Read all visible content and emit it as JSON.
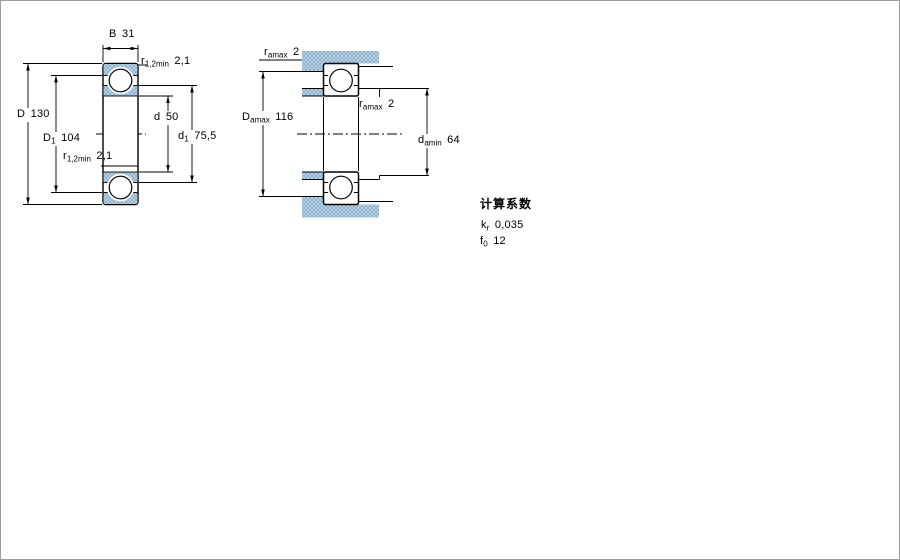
{
  "figures": {
    "left": {
      "name": "bearing cross-section",
      "dims": {
        "B": {
          "sym": "B",
          "value": "31"
        },
        "r_top": {
          "sym": "r",
          "sub": "1,2min",
          "value": "2,1"
        },
        "D": {
          "sym": "D",
          "value": "130"
        },
        "D1": {
          "sym": "D",
          "sub": "1",
          "value": "104"
        },
        "r_mid": {
          "sym": "r",
          "sub": "1,2min",
          "value": "2,1"
        },
        "d": {
          "sym": "d",
          "value": "50"
        },
        "d1": {
          "sym": "d",
          "sub": "1",
          "value": "75,5"
        }
      }
    },
    "right": {
      "name": "abutment and fillet dimensions",
      "dims": {
        "ra_top": {
          "sym": "r",
          "sub": "amax",
          "value": "2"
        },
        "Damax": {
          "sym": "D",
          "sub": "amax",
          "value": "116"
        },
        "ra_mid": {
          "sym": "r",
          "sub": "amax",
          "value": "2"
        },
        "damin": {
          "sym": "d",
          "sub": "amin",
          "value": "64"
        }
      }
    }
  },
  "calculation_factors": {
    "heading": "计算系数",
    "rows": [
      {
        "sym": "k",
        "sub": "r",
        "value": "0,035"
      },
      {
        "sym": "f",
        "sub": "0",
        "value": "12"
      }
    ]
  },
  "colors": {
    "line": "#000000",
    "background": "#ffffff",
    "material_base": "#b7d0e2",
    "material_dot": "#8db2cd"
  }
}
